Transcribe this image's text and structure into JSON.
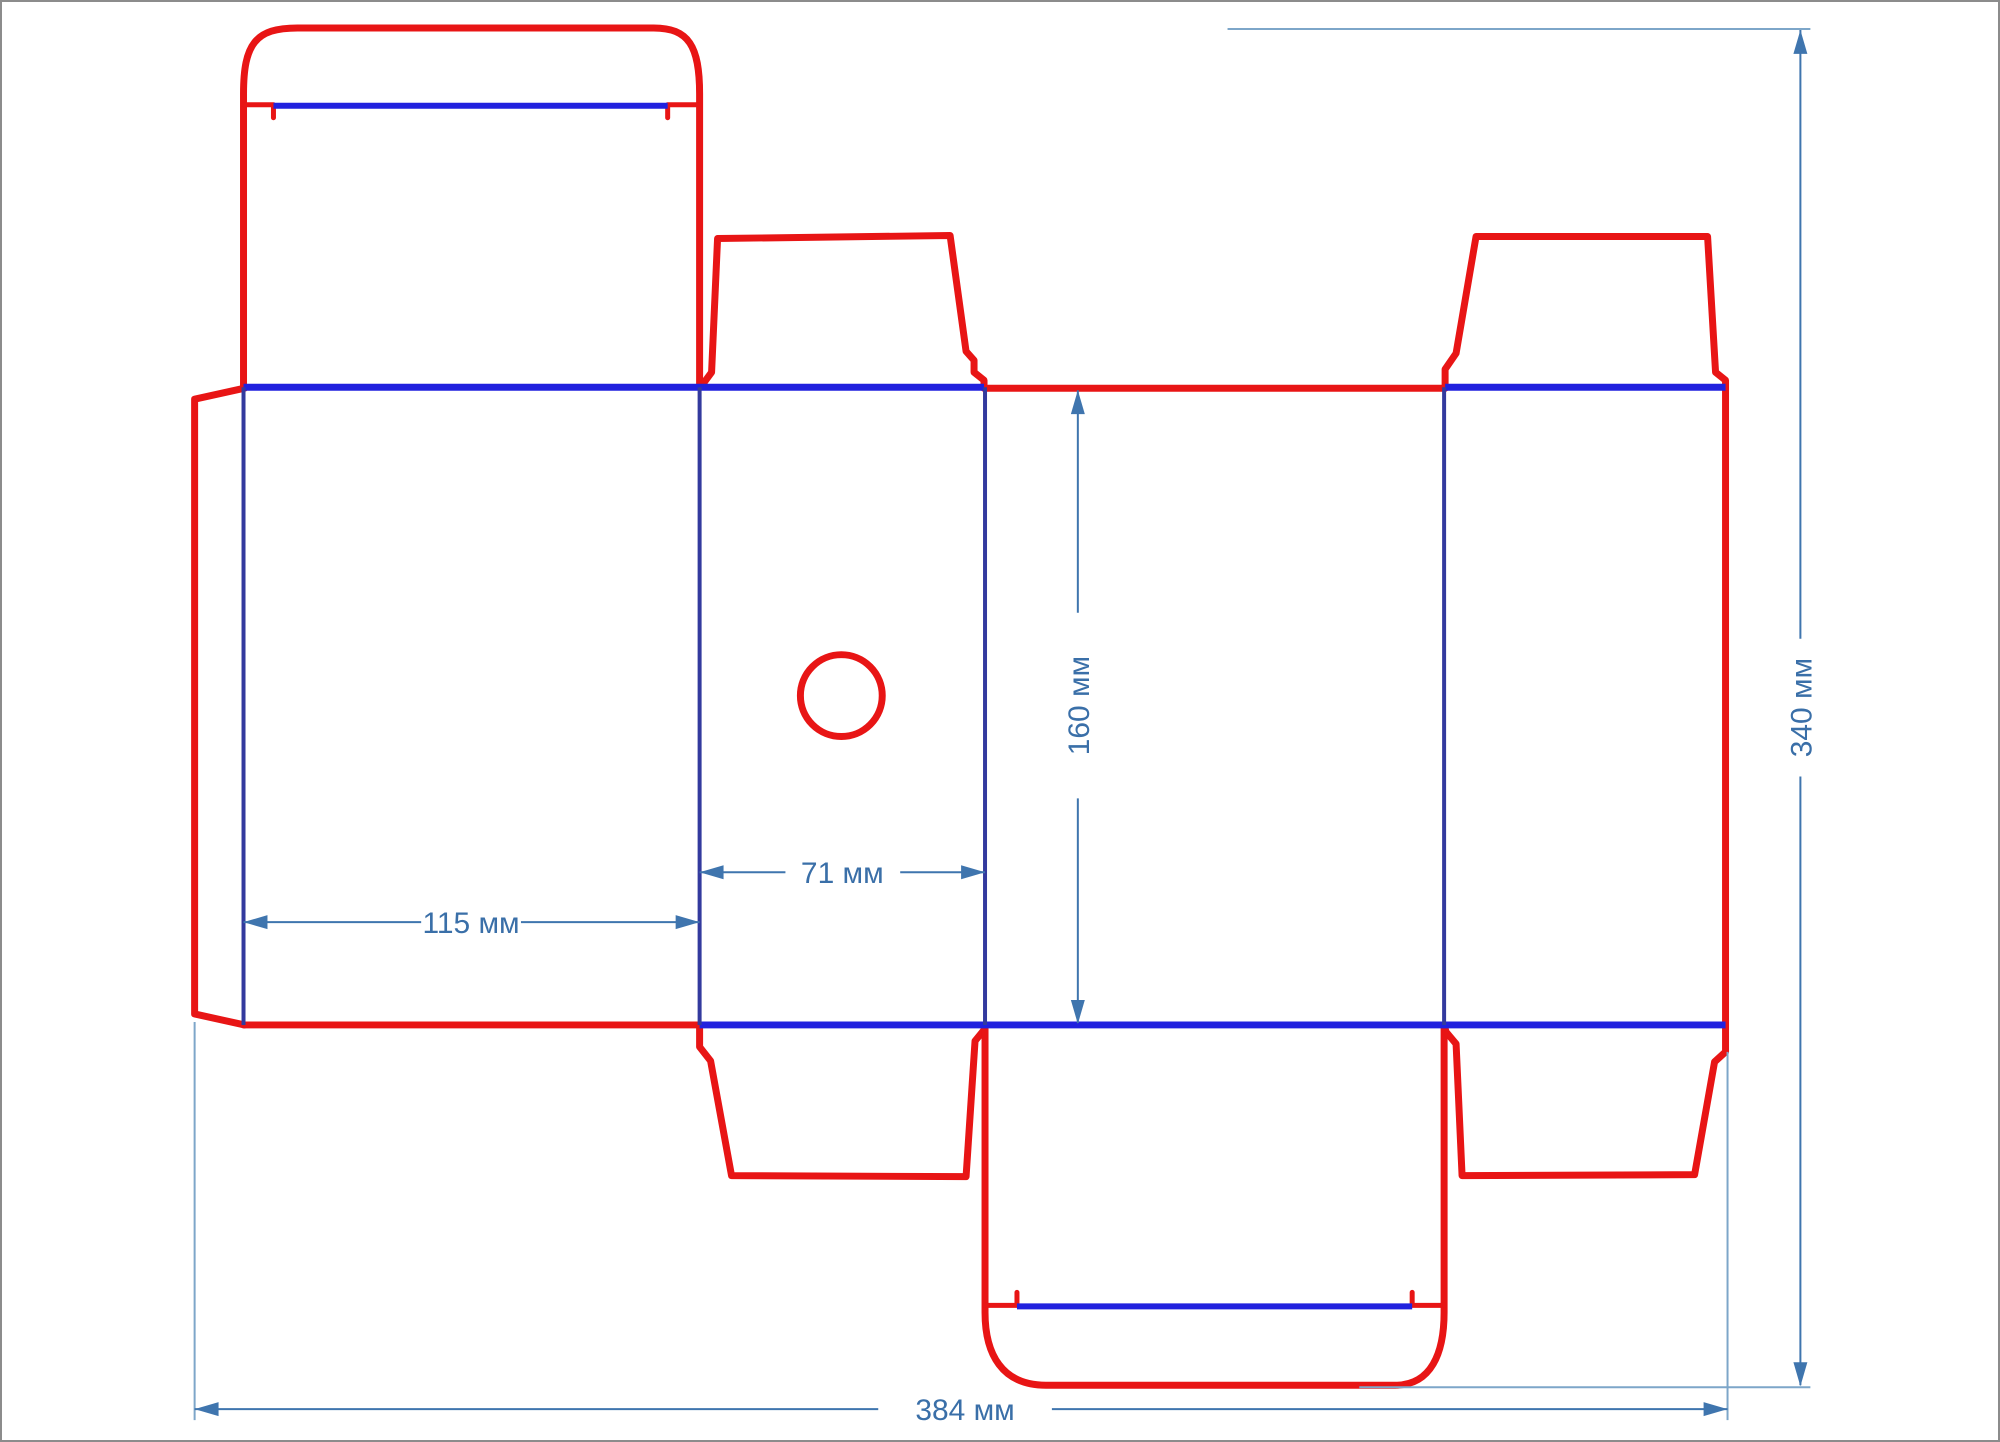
{
  "diagram": {
    "type": "box-dieline-drawing",
    "units": "мм",
    "dimensions": {
      "front_panel_width": {
        "value": 115,
        "label": "115 мм"
      },
      "side_panel_width": {
        "value": 71,
        "label": "71 мм"
      },
      "panel_height": {
        "value": 160,
        "label": "160 мм"
      },
      "total_height": {
        "value": 340,
        "label": "340 мм"
      },
      "total_width": {
        "value": 384,
        "label": "384 мм"
      }
    },
    "legend": {
      "cut_line_meaning": "cut",
      "fold_line_meaning": "fold"
    },
    "colors": {
      "cut_line": "#e81515",
      "fold_line": "#2121de",
      "panel_fold_line": "#333a9e",
      "dimension_line": "#3f75ae",
      "extension_line": "#7da6c9",
      "dimension_text": "#3a6fa8",
      "background": "#ffffff",
      "frame_border": "#8c8c8c"
    }
  }
}
